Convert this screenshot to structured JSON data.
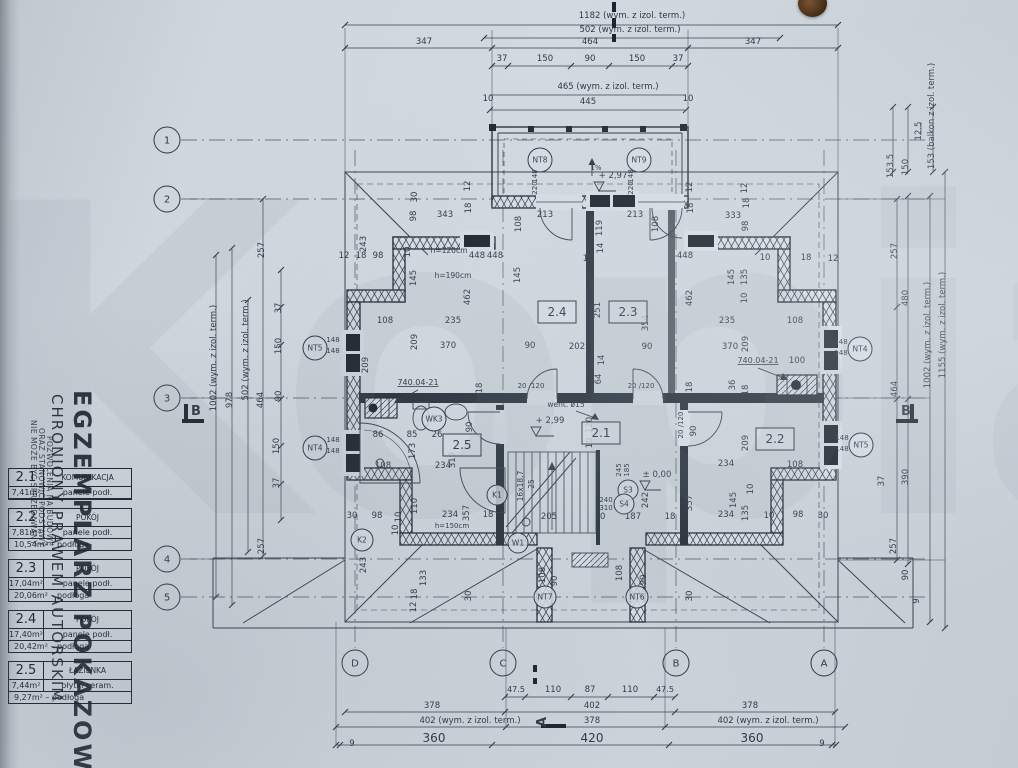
{
  "watermark": "Kopia",
  "stamp": {
    "big": "EGZEMPLARZ POKAZOWY",
    "mid": "CHRONIONY PRAWEM AUTORSKIM",
    "small1": "NIE MOŻE BYĆ SPRZEDAWANY",
    "small2": "ORAZ STANOWIĆ PODSTAWY",
    "small3": "POZWOLENIA NA BUDOWĘ"
  },
  "legend": {
    "rows": [
      {
        "no": "2.1",
        "name": "KOMUNIKACJA",
        "a1": "7,41m²",
        "f1": "panele podł.",
        "a2": "",
        "f2": ""
      },
      {
        "no": "2.2",
        "name": "POKÓJ",
        "a1": "7,81m²",
        "f1": "panele podł.",
        "a2": "10,54m²",
        "f2": "podłoga"
      },
      {
        "no": "2.3",
        "name": "POKÓJ",
        "a1": "17,04m²",
        "f1": "panele podł.",
        "a2": "20,06m²",
        "f2": "podłoga"
      },
      {
        "no": "2.4",
        "name": "POKÓJ",
        "a1": "17,40m²",
        "f1": "panele podł.",
        "a2": "20,42m²",
        "f2": "podłoga"
      },
      {
        "no": "2.5",
        "name": "ŁAZIENKA",
        "a1": "7,44m²",
        "f1": "płytki ceram.",
        "a2": "9,27m²",
        "f2": "podłoga"
      }
    ]
  },
  "axes": {
    "left": [
      {
        "label": "1",
        "x": 167,
        "y": 140
      },
      {
        "label": "2",
        "x": 167,
        "y": 199
      },
      {
        "label": "3",
        "x": 167,
        "y": 398
      },
      {
        "label": "4",
        "x": 167,
        "y": 559
      },
      {
        "label": "5",
        "x": 167,
        "y": 597
      }
    ],
    "bottom": [
      {
        "label": "D",
        "x": 355,
        "y": 663
      },
      {
        "label": "C",
        "x": 503,
        "y": 663
      },
      {
        "label": "B",
        "x": 676,
        "y": 663
      },
      {
        "label": "A",
        "x": 824,
        "y": 663
      }
    ]
  },
  "section_markers": [
    {
      "label": "B",
      "x": 196,
      "y": 415
    },
    {
      "label": "B",
      "x": 906,
      "y": 415
    },
    {
      "label": "A",
      "x": 546,
      "y": 722,
      "r": -90
    }
  ],
  "room_boxes": [
    {
      "label": "2.4",
      "x": 557,
      "y": 312
    },
    {
      "label": "2.3",
      "x": 628,
      "y": 312
    },
    {
      "label": "2.1",
      "x": 601,
      "y": 433
    },
    {
      "label": "2.5",
      "x": 462,
      "y": 445
    },
    {
      "label": "2.2",
      "x": 775,
      "y": 439
    }
  ],
  "circle_markers": [
    {
      "label": "NT8",
      "x": 540,
      "y": 160,
      "r": 12
    },
    {
      "label": "NT9",
      "x": 639,
      "y": 160,
      "r": 12
    },
    {
      "label": "NT5",
      "x": 315,
      "y": 348,
      "r": 12
    },
    {
      "label": "NT4",
      "x": 315,
      "y": 448,
      "r": 12
    },
    {
      "label": "NT4",
      "x": 860,
      "y": 349,
      "r": 12
    },
    {
      "label": "NT5",
      "x": 861,
      "y": 445,
      "r": 12
    },
    {
      "label": "NT7",
      "x": 545,
      "y": 597,
      "r": 11
    },
    {
      "label": "NT6",
      "x": 637,
      "y": 597,
      "r": 11
    },
    {
      "label": "K2",
      "x": 362,
      "y": 540,
      "r": 11
    },
    {
      "label": "K1",
      "x": 497,
      "y": 495,
      "r": 10
    },
    {
      "label": "W1",
      "x": 518,
      "y": 543,
      "r": 10
    },
    {
      "label": "WK3",
      "x": 434,
      "y": 419,
      "r": 12
    },
    {
      "label": "S3",
      "x": 628,
      "y": 490,
      "r": 10
    },
    {
      "label": "S4",
      "x": 624,
      "y": 504,
      "r": 10
    }
  ],
  "dim_labels": [
    {
      "t": "1182 (wym. z izol. term.)",
      "x": 632,
      "y": 18
    },
    {
      "t": "502 (wym. z izol. term.)",
      "x": 630,
      "y": 32
    },
    {
      "t": "347",
      "x": 424,
      "y": 44
    },
    {
      "t": "464",
      "x": 590,
      "y": 44
    },
    {
      "t": "347",
      "x": 753,
      "y": 44
    },
    {
      "t": "37",
      "x": 502,
      "y": 61
    },
    {
      "t": "150",
      "x": 545,
      "y": 61
    },
    {
      "t": "90",
      "x": 590,
      "y": 61
    },
    {
      "t": "150",
      "x": 637,
      "y": 61
    },
    {
      "t": "37",
      "x": 678,
      "y": 61
    },
    {
      "t": "465 (wym. z izol. term.)",
      "x": 608,
      "y": 89
    },
    {
      "t": "10",
      "x": 488,
      "y": 101
    },
    {
      "t": "445",
      "x": 588,
      "y": 104
    },
    {
      "t": "10",
      "x": 688,
      "y": 101
    },
    {
      "t": "153.5",
      "x": 893,
      "y": 166,
      "r": -90
    },
    {
      "t": "150",
      "x": 908,
      "y": 167,
      "r": -90
    },
    {
      "t": "12.5",
      "x": 921,
      "y": 131,
      "r": -90
    },
    {
      "t": "153 (balkon z izol. term.)",
      "x": 934,
      "y": 116,
      "r": -90
    },
    {
      "t": "257",
      "x": 897,
      "y": 251,
      "r": -90
    },
    {
      "t": "480",
      "x": 908,
      "y": 298,
      "r": -90
    },
    {
      "t": "464",
      "x": 897,
      "y": 389,
      "r": -90
    },
    {
      "t": "1002 (wym. z izol. term.)",
      "x": 930,
      "y": 335,
      "r": -90
    },
    {
      "t": "1155 (wym. z izol. term.)",
      "x": 945,
      "y": 325,
      "r": -90
    },
    {
      "t": "390",
      "x": 908,
      "y": 477,
      "r": -90
    },
    {
      "t": "37",
      "x": 884,
      "y": 481,
      "r": -90
    },
    {
      "t": "257",
      "x": 896,
      "y": 546,
      "r": -90
    },
    {
      "t": "90",
      "x": 908,
      "y": 575,
      "r": -90
    },
    {
      "t": "9",
      "x": 919,
      "y": 601,
      "r": -90
    },
    {
      "t": "1002 (wym. z izol. term.)",
      "x": 216,
      "y": 358,
      "r": -90
    },
    {
      "t": "978",
      "x": 232,
      "y": 400,
      "r": -90
    },
    {
      "t": "502 (wym. z izol. term.)",
      "x": 248,
      "y": 350,
      "r": -90
    },
    {
      "t": "464",
      "x": 263,
      "y": 400,
      "r": -90
    },
    {
      "t": "257",
      "x": 264,
      "y": 250,
      "r": -90
    },
    {
      "t": "37",
      "x": 281,
      "y": 308,
      "r": -90
    },
    {
      "t": "150",
      "x": 281,
      "y": 346,
      "r": -90
    },
    {
      "t": "90",
      "x": 281,
      "y": 396,
      "r": -90
    },
    {
      "t": "150",
      "x": 279,
      "y": 446,
      "r": -90
    },
    {
      "t": "37",
      "x": 279,
      "y": 483,
      "r": -90
    },
    {
      "t": "257",
      "x": 264,
      "y": 546,
      "r": -90
    },
    {
      "t": "47.5",
      "x": 516,
      "y": 692,
      "s": 8
    },
    {
      "t": "110",
      "x": 553,
      "y": 692
    },
    {
      "t": "87",
      "x": 590,
      "y": 692
    },
    {
      "t": "110",
      "x": 630,
      "y": 692
    },
    {
      "t": "47.5",
      "x": 665,
      "y": 692,
      "s": 8
    },
    {
      "t": "378",
      "x": 432,
      "y": 708
    },
    {
      "t": "402",
      "x": 592,
      "y": 708
    },
    {
      "t": "378",
      "x": 750,
      "y": 708
    },
    {
      "t": "402 (wym. z izol. term.)",
      "x": 470,
      "y": 723
    },
    {
      "t": "378",
      "x": 592,
      "y": 723
    },
    {
      "t": "402 (wym. z izol. term.)",
      "x": 768,
      "y": 723
    },
    {
      "t": "360",
      "x": 434,
      "y": 742,
      "s": 12
    },
    {
      "t": "420",
      "x": 592,
      "y": 742,
      "s": 12
    },
    {
      "t": "360",
      "x": 752,
      "y": 742,
      "s": 12
    },
    {
      "t": "9",
      "x": 352,
      "y": 746
    },
    {
      "t": "9",
      "x": 822,
      "y": 746
    },
    {
      "t": "30",
      "x": 417,
      "y": 197,
      "r": -90
    },
    {
      "t": "12",
      "x": 470,
      "y": 186,
      "r": -90
    },
    {
      "t": "18",
      "x": 471,
      "y": 208,
      "r": -90
    },
    {
      "t": "98",
      "x": 416,
      "y": 216,
      "r": -90
    },
    {
      "t": "343",
      "x": 445,
      "y": 217
    },
    {
      "t": "243",
      "x": 366,
      "y": 244,
      "r": -90
    },
    {
      "t": "12",
      "x": 344,
      "y": 258
    },
    {
      "t": "18",
      "x": 361,
      "y": 258
    },
    {
      "t": "98",
      "x": 378,
      "y": 258
    },
    {
      "t": "10",
      "x": 410,
      "y": 252,
      "r": -90
    },
    {
      "t": "h=120cm",
      "x": 449,
      "y": 253,
      "s": 7.5
    },
    {
      "t": "448",
      "x": 477,
      "y": 258
    },
    {
      "t": "145",
      "x": 416,
      "y": 278,
      "r": -90
    },
    {
      "t": "h=190cm",
      "x": 453,
      "y": 278,
      "s": 7.5
    },
    {
      "t": "462",
      "x": 470,
      "y": 297,
      "r": -90
    },
    {
      "t": "108",
      "x": 385,
      "y": 323
    },
    {
      "t": "235",
      "x": 453,
      "y": 323
    },
    {
      "t": "209",
      "x": 417,
      "y": 342,
      "r": -90
    },
    {
      "t": "370",
      "x": 448,
      "y": 348
    },
    {
      "t": "90",
      "x": 530,
      "y": 348
    },
    {
      "t": "213",
      "x": 545,
      "y": 217
    },
    {
      "t": "213",
      "x": 635,
      "y": 217
    },
    {
      "t": "108",
      "x": 521,
      "y": 224,
      "r": -90
    },
    {
      "t": "108",
      "x": 658,
      "y": 224,
      "r": -90
    },
    {
      "t": "119",
      "x": 602,
      "y": 228,
      "r": -90
    },
    {
      "t": "14",
      "x": 603,
      "y": 248,
      "r": -90
    },
    {
      "t": "10",
      "x": 588,
      "y": 261
    },
    {
      "t": "448",
      "x": 495,
      "y": 258
    },
    {
      "t": "448",
      "x": 685,
      "y": 258
    },
    {
      "t": "145",
      "x": 520,
      "y": 275,
      "r": -90
    },
    {
      "t": "+ 2,97",
      "x": 613,
      "y": 178,
      "s": 8.5
    },
    {
      "t": "1%",
      "x": 596,
      "y": 170,
      "s": 7
    },
    {
      "t": "148",
      "x": 537,
      "y": 176,
      "r": -90,
      "s": 7
    },
    {
      "t": "220",
      "x": 537,
      "y": 188,
      "r": -90,
      "s": 7
    },
    {
      "t": "148",
      "x": 633,
      "y": 176,
      "r": -90,
      "s": 7
    },
    {
      "t": "220",
      "x": 633,
      "y": 188,
      "r": -90,
      "s": 7
    },
    {
      "t": "12",
      "x": 692,
      "y": 187,
      "r": -90
    },
    {
      "t": "18",
      "x": 693,
      "y": 208,
      "r": -90
    },
    {
      "t": "333",
      "x": 733,
      "y": 218
    },
    {
      "t": "98",
      "x": 748,
      "y": 226,
      "r": -90
    },
    {
      "t": "18",
      "x": 749,
      "y": 203,
      "r": -90
    },
    {
      "t": "12",
      "x": 747,
      "y": 188,
      "r": -90
    },
    {
      "t": "10",
      "x": 765,
      "y": 260
    },
    {
      "t": "18",
      "x": 806,
      "y": 260
    },
    {
      "t": "12",
      "x": 833,
      "y": 261
    },
    {
      "t": "145",
      "x": 734,
      "y": 277,
      "r": -90
    },
    {
      "t": "135",
      "x": 747,
      "y": 277,
      "r": -90
    },
    {
      "t": "10",
      "x": 747,
      "y": 298,
      "r": -90
    },
    {
      "t": "108",
      "x": 795,
      "y": 323
    },
    {
      "t": "235",
      "x": 727,
      "y": 323
    },
    {
      "t": "209",
      "x": 748,
      "y": 344,
      "r": -90
    },
    {
      "t": "370",
      "x": 730,
      "y": 349
    },
    {
      "t": "251",
      "x": 600,
      "y": 310,
      "r": -90
    },
    {
      "t": "354",
      "x": 648,
      "y": 323,
      "r": -90
    },
    {
      "t": "462",
      "x": 692,
      "y": 298,
      "r": -90
    },
    {
      "t": "202",
      "x": 577,
      "y": 349
    },
    {
      "t": "90",
      "x": 647,
      "y": 349
    },
    {
      "t": "14",
      "x": 604,
      "y": 360,
      "r": -90
    },
    {
      "t": "64",
      "x": 601,
      "y": 379,
      "r": -90
    },
    {
      "t": "18",
      "x": 692,
      "y": 387,
      "r": -90
    },
    {
      "t": "36",
      "x": 735,
      "y": 385,
      "r": -90
    },
    {
      "t": "18",
      "x": 748,
      "y": 390,
      "r": -90
    },
    {
      "t": "20 /120",
      "x": 531,
      "y": 388,
      "s": 7
    },
    {
      "t": "20 /120",
      "x": 641,
      "y": 388,
      "s": 7
    },
    {
      "t": "went. ø15",
      "x": 566,
      "y": 407,
      "s": 7.5
    },
    {
      "t": "+ 2,99",
      "x": 550,
      "y": 423,
      "s": 8.5
    },
    {
      "t": "20 /120",
      "x": 683,
      "y": 425,
      "r": -90,
      "s": 7
    },
    {
      "t": "90",
      "x": 696,
      "y": 431,
      "r": -90
    },
    {
      "t": "120",
      "x": 592,
      "y": 425,
      "r": -90
    },
    {
      "t": "10",
      "x": 592,
      "y": 443,
      "r": -90
    },
    {
      "t": "209",
      "x": 748,
      "y": 443,
      "r": -90
    },
    {
      "t": "740.04-21",
      "x": 418,
      "y": 385,
      "s": 8,
      "u": 1
    },
    {
      "t": "740.04-21",
      "x": 758,
      "y": 363,
      "s": 8,
      "u": 1
    },
    {
      "t": "100",
      "x": 797,
      "y": 363
    },
    {
      "t": "209",
      "x": 368,
      "y": 365,
      "r": -90
    },
    {
      "t": "18",
      "x": 482,
      "y": 388,
      "r": -90
    },
    {
      "t": "86",
      "x": 378,
      "y": 437
    },
    {
      "t": "85",
      "x": 412,
      "y": 437
    },
    {
      "t": "26",
      "x": 437,
      "y": 437
    },
    {
      "t": "90",
      "x": 472,
      "y": 427,
      "r": -90
    },
    {
      "t": "173",
      "x": 415,
      "y": 451,
      "r": -90
    },
    {
      "t": "319",
      "x": 455,
      "y": 460,
      "r": -90
    },
    {
      "t": "108",
      "x": 383,
      "y": 468
    },
    {
      "t": "234",
      "x": 443,
      "y": 468
    },
    {
      "t": "110",
      "x": 417,
      "y": 506,
      "r": -90
    },
    {
      "t": "10",
      "x": 401,
      "y": 517,
      "r": -90
    },
    {
      "t": "10",
      "x": 398,
      "y": 530,
      "r": -90
    },
    {
      "t": "234",
      "x": 450,
      "y": 517
    },
    {
      "t": "357",
      "x": 469,
      "y": 513,
      "r": -90
    },
    {
      "t": "h=150cm",
      "x": 452,
      "y": 528,
      "s": 7
    },
    {
      "t": "30",
      "x": 352,
      "y": 518
    },
    {
      "t": "98",
      "x": 377,
      "y": 518
    },
    {
      "t": "18",
      "x": 488,
      "y": 517
    },
    {
      "t": "234",
      "x": 726,
      "y": 466
    },
    {
      "t": "108",
      "x": 795,
      "y": 467
    },
    {
      "t": "145",
      "x": 736,
      "y": 500,
      "r": -90
    },
    {
      "t": "135",
      "x": 748,
      "y": 513,
      "r": -90
    },
    {
      "t": "10",
      "x": 753,
      "y": 489,
      "r": -90
    },
    {
      "t": "357",
      "x": 692,
      "y": 503,
      "r": -90
    },
    {
      "t": "30",
      "x": 823,
      "y": 518
    },
    {
      "t": "98",
      "x": 798,
      "y": 517
    },
    {
      "t": "10",
      "x": 769,
      "y": 518
    },
    {
      "t": "234",
      "x": 726,
      "y": 517
    },
    {
      "t": "16x18,7",
      "x": 523,
      "y": 486,
      "r": -90,
      "s": 7.5
    },
    {
      "t": "25",
      "x": 534,
      "y": 484,
      "r": -90,
      "s": 7.5
    },
    {
      "t": "205",
      "x": 549,
      "y": 519
    },
    {
      "t": "10",
      "x": 600,
      "y": 519
    },
    {
      "t": "187",
      "x": 633,
      "y": 519
    },
    {
      "t": "18",
      "x": 670,
      "y": 519
    },
    {
      "t": "240",
      "x": 606,
      "y": 502,
      "s": 7
    },
    {
      "t": "310",
      "x": 606,
      "y": 510,
      "s": 7
    },
    {
      "t": "245",
      "x": 621,
      "y": 470,
      "r": -90,
      "s": 7
    },
    {
      "t": "185",
      "x": 629,
      "y": 470,
      "r": -90,
      "s": 7
    },
    {
      "t": "242",
      "x": 648,
      "y": 500,
      "r": -90
    },
    {
      "t": "± 0,00",
      "x": 657,
      "y": 477,
      "s": 8.5
    },
    {
      "t": "108",
      "x": 545,
      "y": 575,
      "r": -90
    },
    {
      "t": "90",
      "x": 557,
      "y": 581,
      "r": -90
    },
    {
      "t": "108",
      "x": 622,
      "y": 573,
      "r": -90
    },
    {
      "t": "90",
      "x": 646,
      "y": 580,
      "r": -90
    },
    {
      "t": "133",
      "x": 426,
      "y": 578,
      "r": -90
    },
    {
      "t": "18",
      "x": 417,
      "y": 594,
      "r": -90
    },
    {
      "t": "12",
      "x": 416,
      "y": 607,
      "r": -90
    },
    {
      "t": "30",
      "x": 471,
      "y": 596,
      "r": -90
    },
    {
      "t": "30",
      "x": 692,
      "y": 596,
      "r": -90
    },
    {
      "t": "243",
      "x": 366,
      "y": 565,
      "r": -90
    },
    {
      "t": "148",
      "x": 333,
      "y": 342,
      "s": 7
    },
    {
      "t": "148",
      "x": 333,
      "y": 353,
      "s": 7
    },
    {
      "t": "148",
      "x": 333,
      "y": 442,
      "s": 7
    },
    {
      "t": "148",
      "x": 333,
      "y": 453,
      "s": 7
    },
    {
      "t": "148",
      "x": 841,
      "y": 344,
      "s": 7
    },
    {
      "t": "148",
      "x": 841,
      "y": 355,
      "s": 7
    },
    {
      "t": "148",
      "x": 842,
      "y": 440,
      "s": 7
    },
    {
      "t": "148",
      "x": 842,
      "y": 451,
      "s": 7
    }
  ]
}
